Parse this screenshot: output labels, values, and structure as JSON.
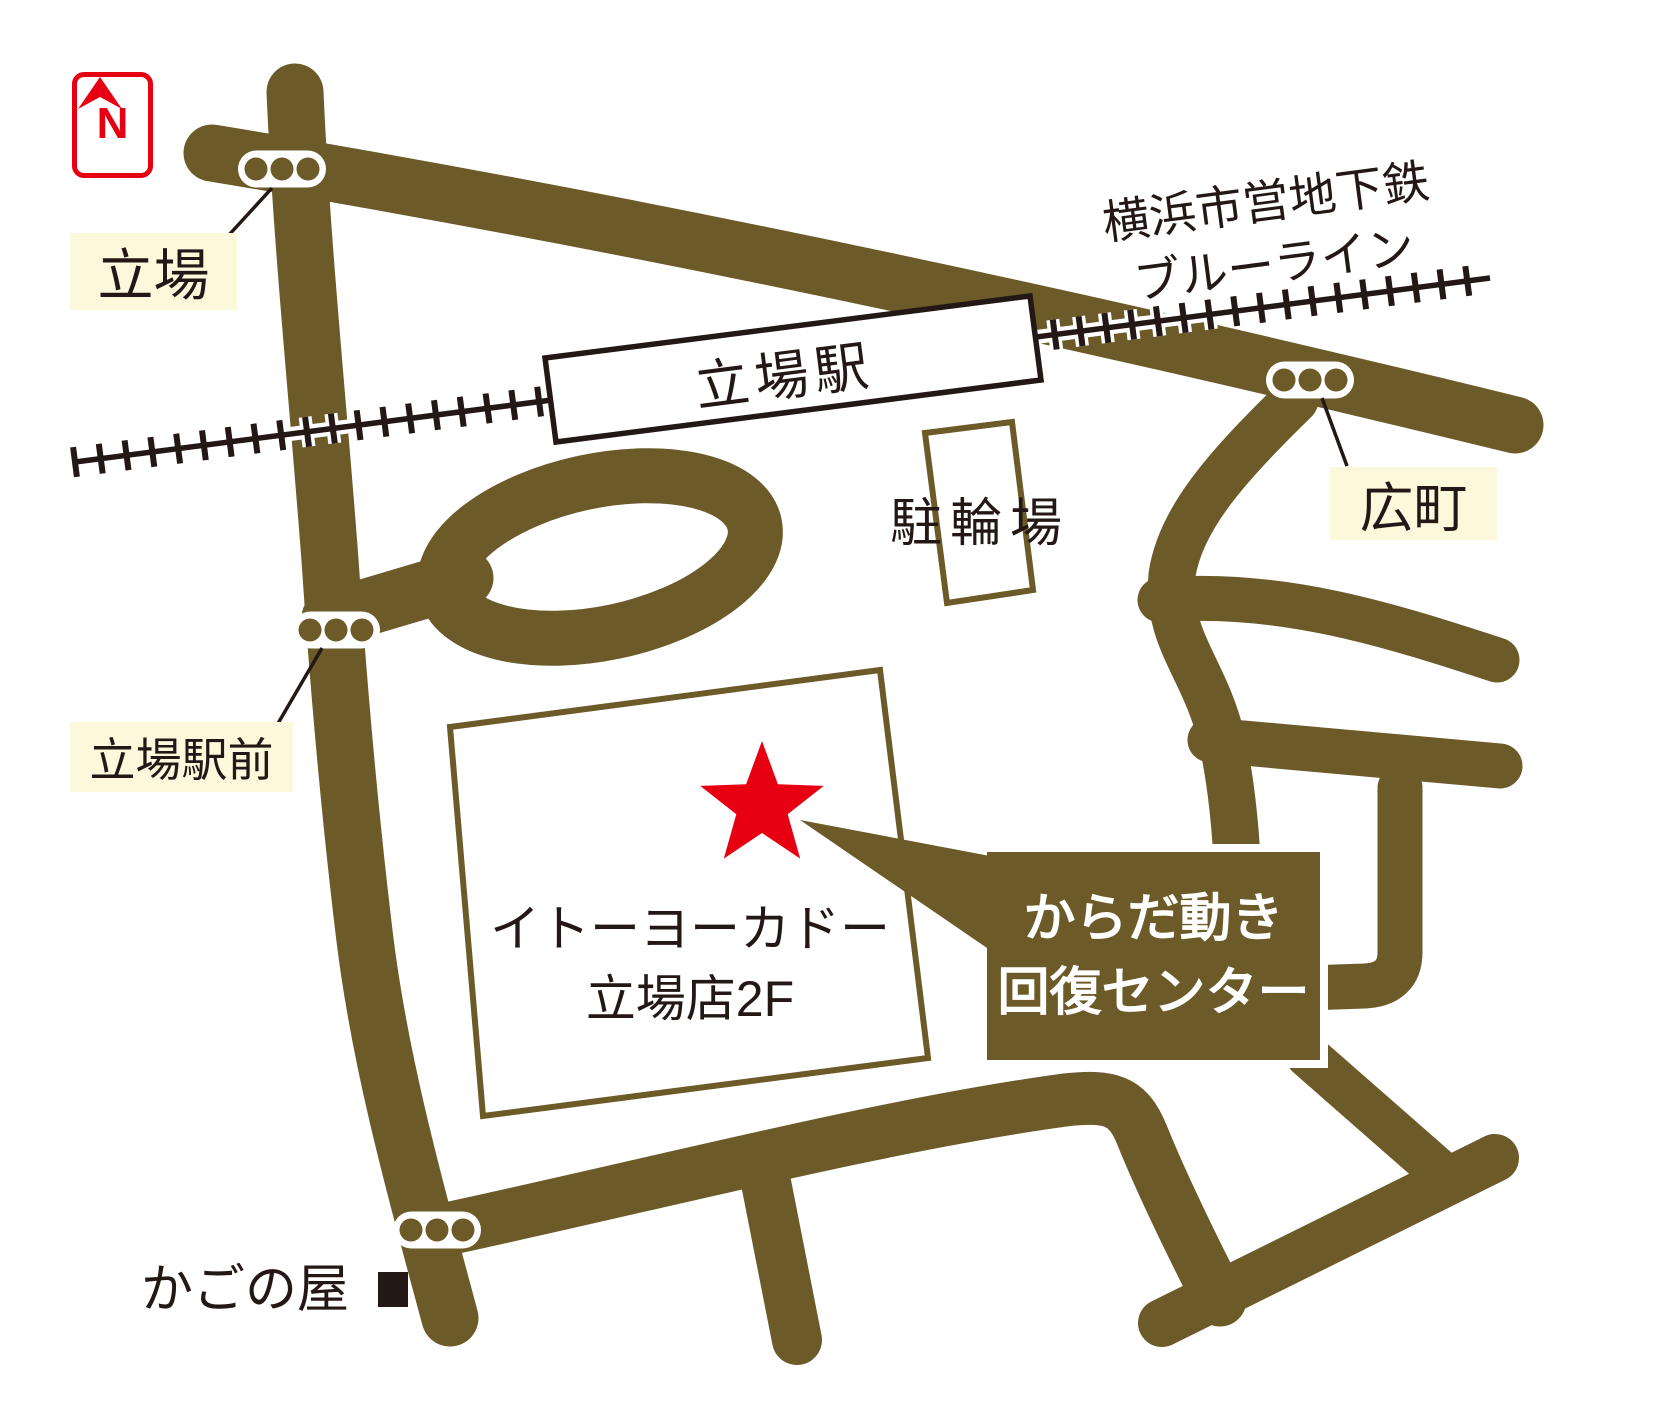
{
  "colors": {
    "road": "#6c5a28",
    "ink": "#231815",
    "label_bg": "#fcf8dc",
    "accent_red": "#e60012",
    "white": "#ffffff"
  },
  "compass": {
    "letter": "N"
  },
  "subway": {
    "line1": "横浜市営地下鉄",
    "line2": "ブルーライン"
  },
  "station": {
    "name": "立場駅"
  },
  "intersections": {
    "tateba": "立場",
    "hiromachi": "広町",
    "tateba_ekimae": "立場駅前"
  },
  "bicycle_parking": {
    "label": "駐輪場"
  },
  "building": {
    "line1": "イトーヨーカドー",
    "line2": "立場店2F"
  },
  "destination": {
    "line1": "からだ動き",
    "line2": "回復センター"
  },
  "landmarks": {
    "kagonoya": "かごの屋"
  }
}
